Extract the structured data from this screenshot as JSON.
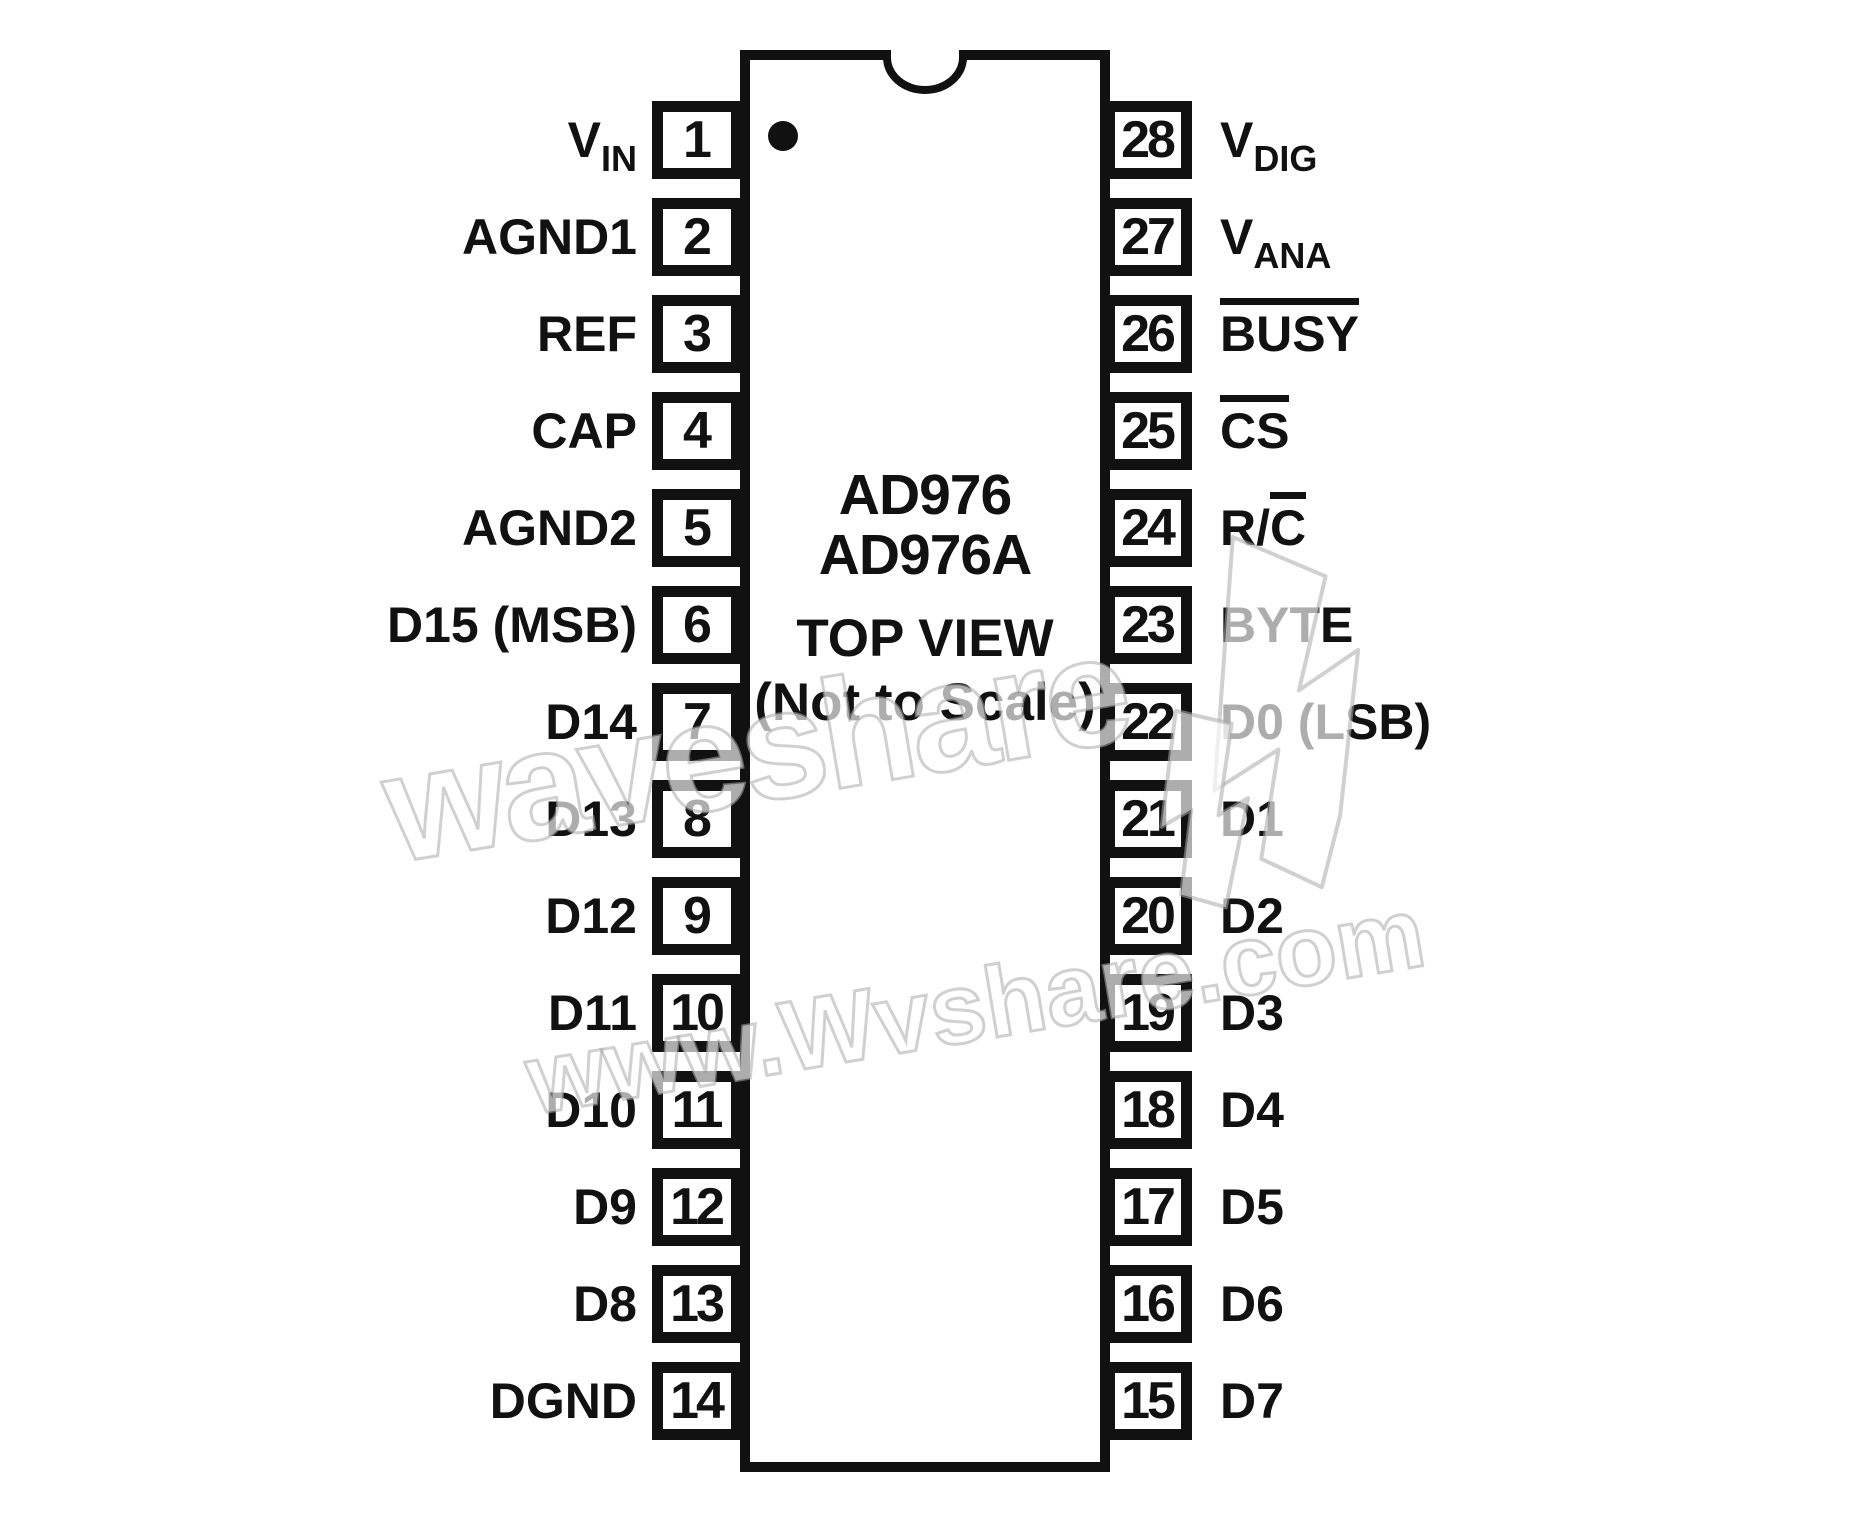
{
  "chip": {
    "name_line1": "AD976",
    "name_line2": "AD976A",
    "view_label": "TOP VIEW",
    "scale_note": "(Not to Scale)"
  },
  "left_pins": [
    {
      "num": "1",
      "segments": [
        {
          "text": "V"
        },
        {
          "text": "IN",
          "sub": true
        }
      ]
    },
    {
      "num": "2",
      "segments": [
        {
          "text": "AGND1"
        }
      ]
    },
    {
      "num": "3",
      "segments": [
        {
          "text": "REF"
        }
      ]
    },
    {
      "num": "4",
      "segments": [
        {
          "text": "CAP"
        }
      ]
    },
    {
      "num": "5",
      "segments": [
        {
          "text": "AGND2"
        }
      ]
    },
    {
      "num": "6",
      "segments": [
        {
          "text": "D15 (MSB)"
        }
      ]
    },
    {
      "num": "7",
      "segments": [
        {
          "text": "D14"
        }
      ]
    },
    {
      "num": "8",
      "segments": [
        {
          "text": "D13"
        }
      ]
    },
    {
      "num": "9",
      "segments": [
        {
          "text": "D12"
        }
      ]
    },
    {
      "num": "10",
      "segments": [
        {
          "text": "D11"
        }
      ]
    },
    {
      "num": "11",
      "segments": [
        {
          "text": "D10"
        }
      ]
    },
    {
      "num": "12",
      "segments": [
        {
          "text": "D9"
        }
      ]
    },
    {
      "num": "13",
      "segments": [
        {
          "text": "D8"
        }
      ]
    },
    {
      "num": "14",
      "segments": [
        {
          "text": "DGND"
        }
      ]
    }
  ],
  "right_pins": [
    {
      "num": "28",
      "segments": [
        {
          "text": "V"
        },
        {
          "text": "DIG",
          "sub": true
        }
      ]
    },
    {
      "num": "27",
      "segments": [
        {
          "text": "V"
        },
        {
          "text": "ANA",
          "sub": true
        }
      ]
    },
    {
      "num": "26",
      "segments": [
        {
          "text": "BUSY",
          "over": true
        }
      ]
    },
    {
      "num": "25",
      "segments": [
        {
          "text": "CS",
          "over": true
        }
      ]
    },
    {
      "num": "24",
      "segments": [
        {
          "text": "R/"
        },
        {
          "text": "C",
          "over": true
        }
      ]
    },
    {
      "num": "23",
      "segments": [
        {
          "text": "BYTE"
        }
      ]
    },
    {
      "num": "22",
      "segments": [
        {
          "text": "D0 (LSB)"
        }
      ]
    },
    {
      "num": "21",
      "segments": [
        {
          "text": "D1"
        }
      ]
    },
    {
      "num": "20",
      "segments": [
        {
          "text": "D2"
        }
      ]
    },
    {
      "num": "19",
      "segments": [
        {
          "text": "D3"
        }
      ]
    },
    {
      "num": "18",
      "segments": [
        {
          "text": "D4"
        }
      ]
    },
    {
      "num": "17",
      "segments": [
        {
          "text": "D5"
        }
      ]
    },
    {
      "num": "16",
      "segments": [
        {
          "text": "D6"
        }
      ]
    },
    {
      "num": "15",
      "segments": [
        {
          "text": "D7"
        }
      ]
    }
  ],
  "watermark": {
    "word": "waveshare",
    "url": "www.Wvshare.com"
  },
  "colors": {
    "ink": "#111111",
    "background": "#ffffff",
    "watermark_stroke": "#aaaaaa"
  }
}
